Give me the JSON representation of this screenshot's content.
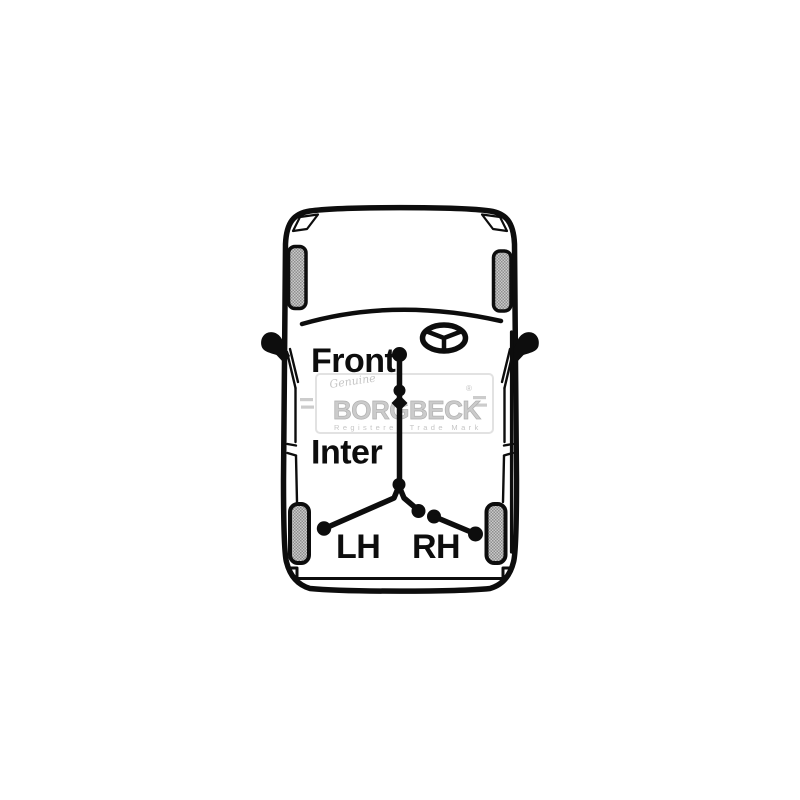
{
  "page": {
    "background_color": "#ffffff",
    "description": "Top view line drawing of a vehicle showing handbrake cable fitting positions"
  },
  "diagram": {
    "labels": {
      "front": "Front",
      "inter": "Inter",
      "lh": "LH",
      "rh": "RH"
    },
    "colors": {
      "line": "#0d0d0d",
      "wheel_light": "#cacaca",
      "wheel_dark": "#8e8e8e",
      "watermark": "#c9c9c9"
    },
    "watermark": {
      "script": "Genuine",
      "brand_left": "BORG",
      "brand_right": "BECK",
      "registered_symbol": "®",
      "tagline": "Registered Trade Mark"
    }
  }
}
